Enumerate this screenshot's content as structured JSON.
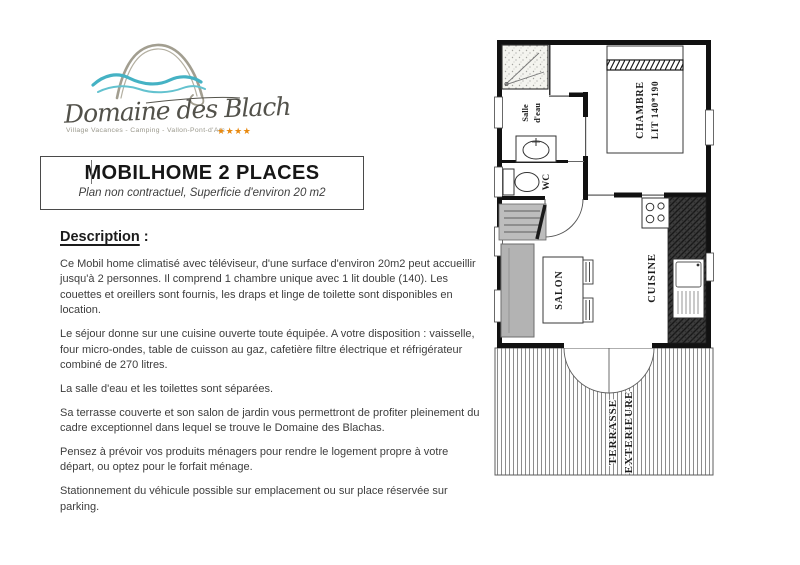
{
  "logo": {
    "name": "Domaine des Blachas",
    "tagline": "Village Vacances - Camping - Vallon-Pont-d'Arc",
    "stars": "★★★★"
  },
  "title_box": {
    "title": "MOBILHOME 2 PLACES",
    "subtitle": "Plan non contractuel, Superficie d'environ 20 m2"
  },
  "description": {
    "heading": "Description",
    "heading_suffix": " :",
    "paragraphs": [
      "Ce Mobil home climatisé avec téléviseur, d'une surface d'environ 20m2 peut accueillir jusqu'à 2 personnes. Il comprend 1 chambre unique avec 1 lit double (140). Les couettes et oreillers sont fournis, les draps et linge de toilette sont disponibles en location.",
      "Le séjour donne sur une cuisine ouverte toute équipée. A votre disposition : vaisselle, four micro-ondes, table de cuisson au gaz, cafetière filtre électrique et réfrigérateur combiné de 270 litres.",
      "La salle d'eau et les toilettes sont séparées.",
      "Sa terrasse couverte et son salon de jardin vous permettront de profiter pleinement du cadre exceptionnel dans lequel se trouve le Domaine des Blachas.",
      "Pensez à prévoir vos produits ménagers pour rendre le logement propre à votre départ, ou optez pour le forfait ménage.",
      "Stationnement du véhicule possible sur emplacement ou sur place réservée sur parking."
    ]
  },
  "floorplan": {
    "rooms": {
      "salle_eau_line1": "Salle",
      "salle_eau_line2": "d'eau",
      "wc": "WC",
      "chambre_line1": "CHAMBRE",
      "chambre_line2": "LIT 140*190",
      "salon": "SALON",
      "cuisine": "CUISINE",
      "terrasse_line1": "TERRASSE",
      "terrasse_line2": "EXTERIEURE"
    }
  },
  "colors": {
    "wave_blue": "#4ab3c4",
    "arch_gray": "#a29e90",
    "star_orange": "#e8890f",
    "body_text": "#3d3d3d",
    "wall_black": "#111111",
    "furniture_gray": "#b5b5b5"
  }
}
